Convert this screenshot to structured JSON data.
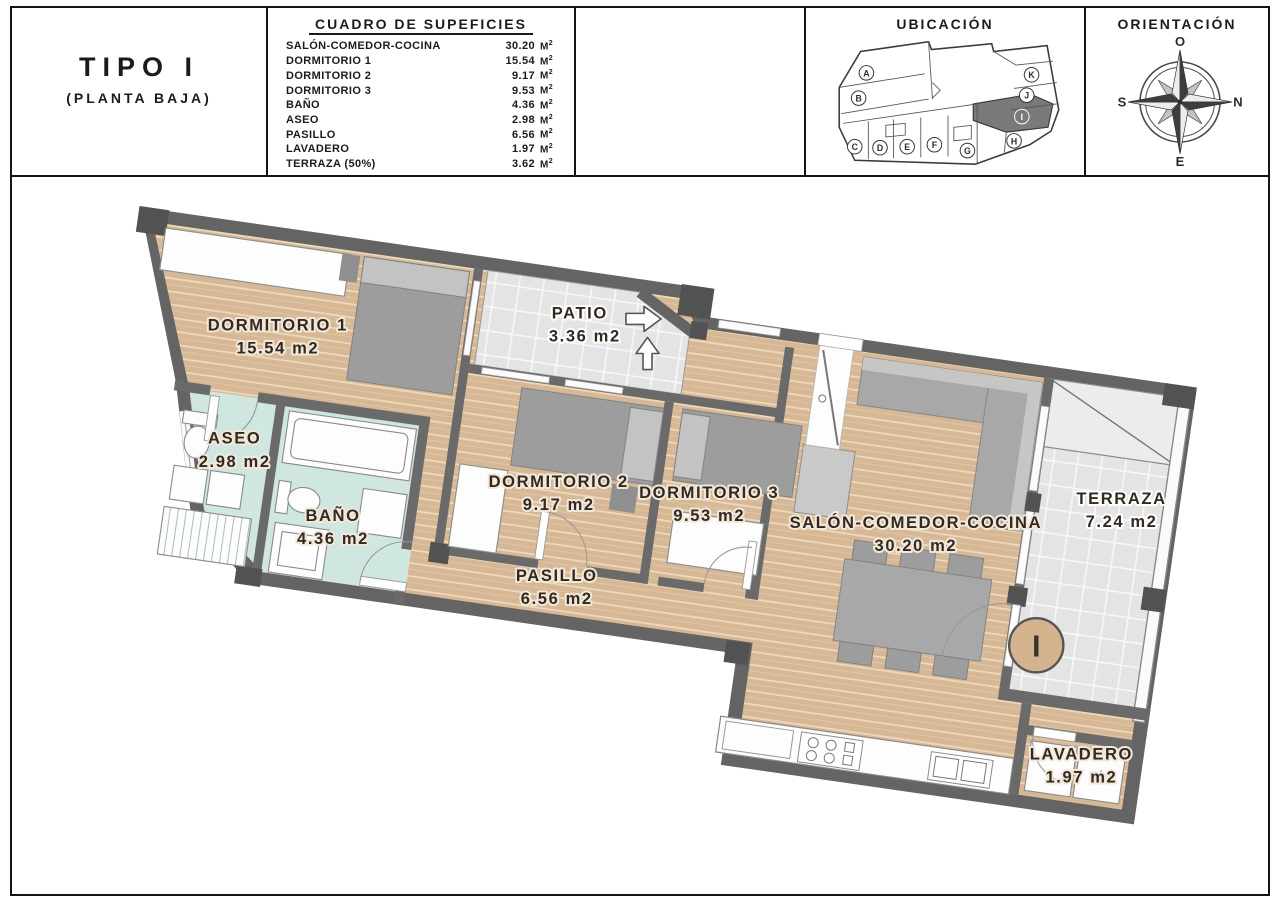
{
  "header": {
    "type_title": "TIPO I",
    "type_subtitle": "(PLANTA BAJA)",
    "table": {
      "title": "CUADRO DE SUPEFICIES",
      "unit_m": "M",
      "unit_exp": "2",
      "rows": [
        {
          "name": "SALÓN-COMEDOR-COCINA",
          "value": "30.20"
        },
        {
          "name": "DORMITORIO 1",
          "value": "15.54"
        },
        {
          "name": "DORMITORIO 2",
          "value": "9.17"
        },
        {
          "name": "DORMITORIO 3",
          "value": "9.53"
        },
        {
          "name": "BAÑO",
          "value": "4.36"
        },
        {
          "name": "ASEO",
          "value": "2.98"
        },
        {
          "name": "PASILLO",
          "value": "6.56"
        },
        {
          "name": "LAVADERO",
          "value": "1.97"
        },
        {
          "name": "TERRAZA (50%)",
          "value": "3.62"
        }
      ],
      "totals": [
        {
          "name": "SUPERFICIE ÚTIL TOTAL",
          "value": "83.93"
        },
        {
          "name": "PATIO",
          "value": "3.36"
        },
        {
          "name": "TERRAZA (100%)",
          "value": "7.24"
        }
      ]
    },
    "ubicacion": {
      "title": "UBICACIÓN",
      "units": [
        "A",
        "B",
        "C",
        "D",
        "E",
        "F",
        "G",
        "H",
        "I",
        "J",
        "K"
      ],
      "highlighted_unit": "I"
    },
    "orientacion": {
      "title": "ORIENTACIÓN",
      "points": {
        "top": "O",
        "right": "N",
        "bottom": "E",
        "left": "S"
      }
    }
  },
  "plan": {
    "rooms": {
      "dormitorio1": {
        "name": "DORMITORIO 1",
        "area": "15.54 m2"
      },
      "patio": {
        "name": "PATIO",
        "area": "3.36 m2"
      },
      "dormitorio2": {
        "name": "DORMITORIO 2",
        "area": "9.17 m2"
      },
      "dormitorio3": {
        "name": "DORMITORIO 3",
        "area": "9.53 m2"
      },
      "aseo": {
        "name": "ASEO",
        "area": "2.98 m2"
      },
      "bano": {
        "name": "BAÑO",
        "area": "4.36 m2"
      },
      "pasillo": {
        "name": "PASILLO",
        "area": "6.56 m2"
      },
      "salon": {
        "name": "SALÓN-COMEDOR-COCINA",
        "area": "30.20 m2"
      },
      "terraza": {
        "name": "TERRAZA",
        "area": "7.24 m2"
      },
      "lavadero": {
        "name": "LAVADERO",
        "area": "1.97 m2"
      }
    },
    "unit_marker": "I",
    "colors": {
      "wall": "#646464",
      "wood": "#d7b896",
      "wet_room": "#cfe6e1",
      "tile": "#e4e4e4",
      "label": "#33291f"
    }
  }
}
